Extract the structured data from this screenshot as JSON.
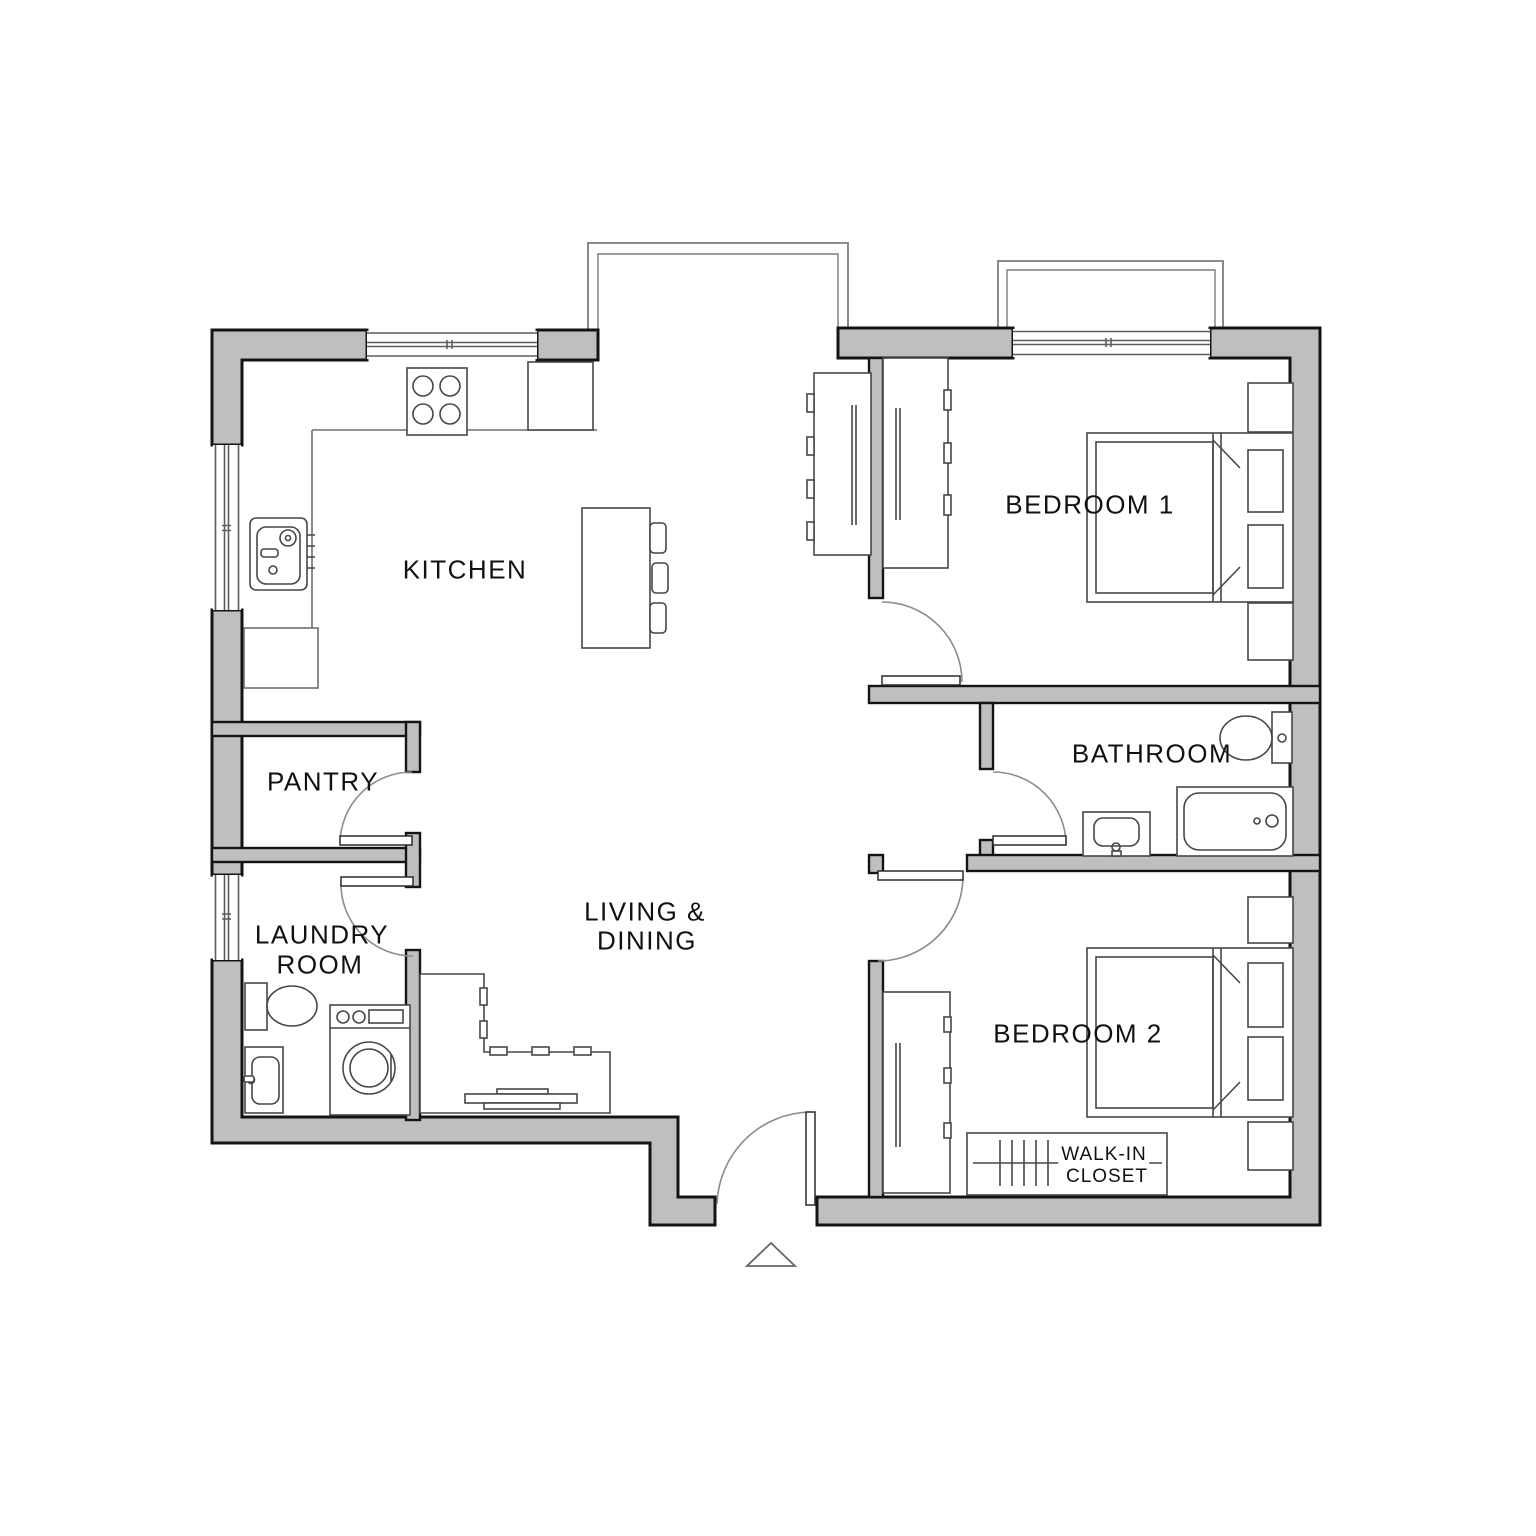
{
  "rooms": {
    "kitchen": {
      "label": "KITCHEN"
    },
    "bedroom1": {
      "label": "BEDROOM 1"
    },
    "bathroom": {
      "label": "BATHROOM"
    },
    "pantry": {
      "label": "PANTRY"
    },
    "laundry_room": {
      "line1": "LAUNDRY",
      "line2": "ROOM"
    },
    "living_dining": {
      "line1": "LIVING &",
      "line2": "DINING"
    },
    "bedroom2": {
      "label": "BEDROOM 2"
    },
    "walk_in_closet": {
      "line1": "WALK-IN",
      "line2": "CLOSET"
    }
  },
  "icons": [
    "stove-icon",
    "fridge-icon",
    "kitchen-sink-icon",
    "island-icon",
    "stool-icon",
    "sofa-icon",
    "coffee-table-icon",
    "wardrobe-icon",
    "hanging-rail-icon",
    "bed-icon",
    "nightstand-icon",
    "toilet-icon",
    "bathtub-icon",
    "bathroom-sink-icon",
    "laundry-sink-icon",
    "washing-machine-icon",
    "door-swing-icon",
    "window-icon",
    "bay-window-icon",
    "entry-triangle-icon"
  ],
  "colors": {
    "background": "#ffffff",
    "wall_fill": "#bfbfbf",
    "wall_outline": "#141414",
    "furniture_line": "#474747",
    "thin_line": "#7c7c7c",
    "label_text": "#111111"
  }
}
